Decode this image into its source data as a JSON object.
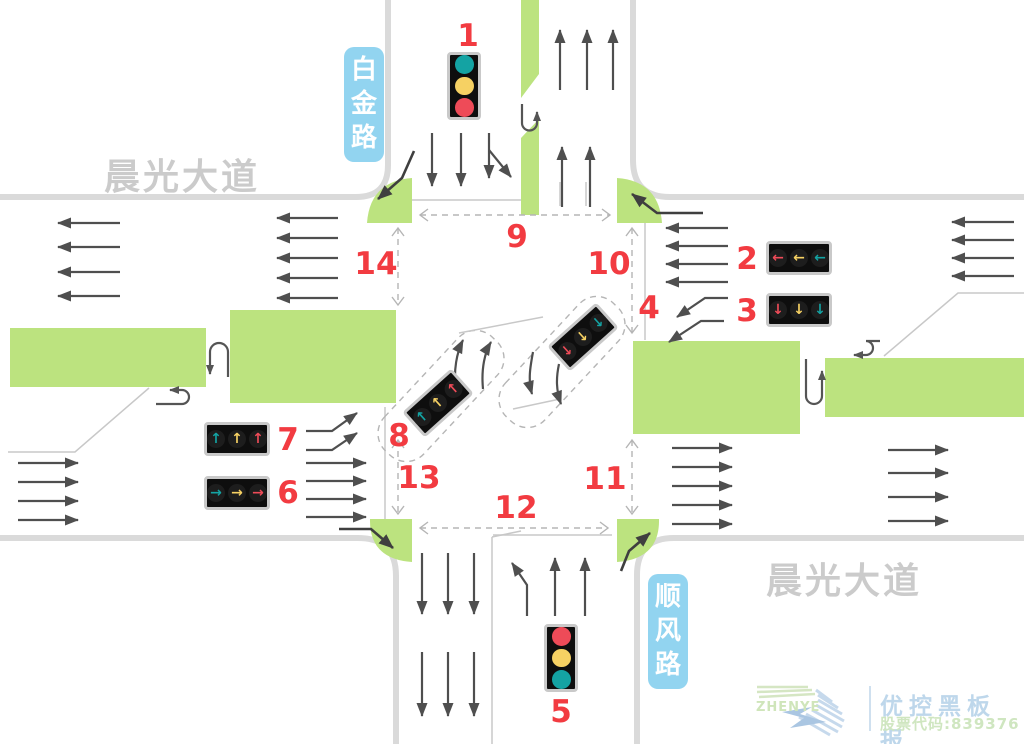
{
  "canvas": {
    "background": "#ffffff"
  },
  "colors": {
    "green_island": "#bce37f",
    "road_edge": "#dadada",
    "lane_line": "#c8c8c8",
    "arrow_gray": "#4f4f4f",
    "dash_gray": "#b5b5b5",
    "number_red": "#f23b41",
    "label_blue": "#92d4f0",
    "avenue_gray": "#cbcbcb",
    "signal_teal": "#14a3a3",
    "signal_yellow": "#f6d163",
    "signal_red": "#ee4b58"
  },
  "roads": {
    "avenue_top_left": "晨光大道",
    "avenue_bottom_right": "晨光大道",
    "north_road": "白金路",
    "south_road": "顺风路"
  },
  "markers": {
    "m1": "1",
    "m2": "2",
    "m3": "3",
    "m4": "4",
    "m5": "5",
    "m6": "6",
    "m7": "7",
    "m8": "8",
    "m9": "9",
    "m10": "10",
    "m11": "11",
    "m12": "12",
    "m13": "13",
    "m14": "14"
  },
  "lights": {
    "l1": {
      "type": "round",
      "lamps": [
        {
          "color": "#14a3a3"
        },
        {
          "color": "#f6d163"
        },
        {
          "color": "#ee4b58"
        }
      ]
    },
    "l2": {
      "type": "arrow",
      "lamps": [
        {
          "glyph": "←",
          "color": "#ee4b58"
        },
        {
          "glyph": "←",
          "color": "#f6d163"
        },
        {
          "glyph": "←",
          "color": "#14a3a3"
        }
      ]
    },
    "l3": {
      "type": "arrow",
      "lamps": [
        {
          "glyph": "↓",
          "color": "#ee4b58"
        },
        {
          "glyph": "↓",
          "color": "#f6d163"
        },
        {
          "glyph": "↓",
          "color": "#14a3a3"
        }
      ]
    },
    "l4": {
      "type": "arrow",
      "lamps": [
        {
          "glyph": "↓",
          "color": "#ee4b58"
        },
        {
          "glyph": "↓",
          "color": "#f6d163"
        },
        {
          "glyph": "↓",
          "color": "#14a3a3"
        }
      ]
    },
    "l5": {
      "type": "round",
      "lamps": [
        {
          "color": "#ee4b58"
        },
        {
          "color": "#f6d163"
        },
        {
          "color": "#14a3a3"
        }
      ]
    },
    "l6": {
      "type": "arrow",
      "lamps": [
        {
          "glyph": "→",
          "color": "#14a3a3"
        },
        {
          "glyph": "→",
          "color": "#f6d163"
        },
        {
          "glyph": "→",
          "color": "#ee4b58"
        }
      ]
    },
    "l7": {
      "type": "arrow",
      "lamps": [
        {
          "glyph": "↑",
          "color": "#14a3a3"
        },
        {
          "glyph": "↑",
          "color": "#f6d163"
        },
        {
          "glyph": "↑",
          "color": "#ee4b58"
        }
      ]
    },
    "l8": {
      "type": "arrow",
      "lamps": [
        {
          "glyph": "↑",
          "color": "#14a3a3"
        },
        {
          "glyph": "↑",
          "color": "#f6d163"
        },
        {
          "glyph": "↑",
          "color": "#ee4b58"
        }
      ]
    }
  },
  "watermark": {
    "brand": "ZHENYE",
    "title": "优控黑板报",
    "stock": "股票代码:839376"
  }
}
